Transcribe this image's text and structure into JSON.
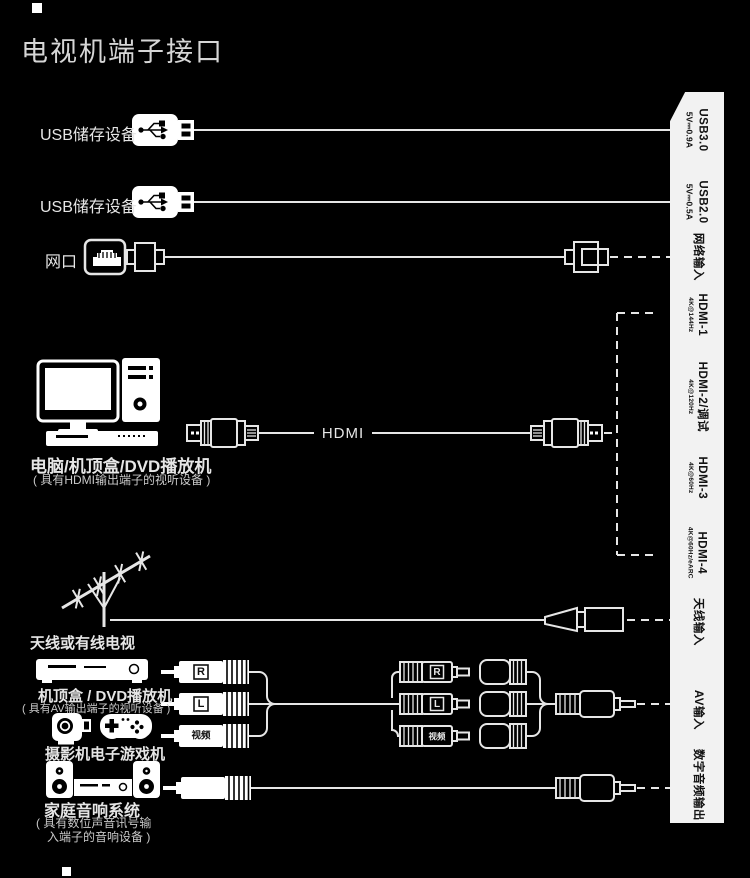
{
  "title": "电视机端子接口",
  "left": {
    "usb3_label": "USB储存设备",
    "usb2_label": "USB储存设备",
    "lan_label": "网口",
    "hdmi_device_label": "电脑/机顶盒/DVD播放机",
    "hdmi_device_sub": "( 具有HDMI输出端子的视听设备 )",
    "hdmi_cable_label": "HDMI",
    "antenna_label": "天线或有线电视",
    "av_device_label": "机顶盒 / DVD播放机",
    "av_device_sub": "( 具有AV输出端子的视听设备 )",
    "camera_label": "摄影机",
    "game_label": "电子游戏机",
    "audio_device_label": "家庭音响系统",
    "audio_device_sub1": "( 具有数位声音讯号输",
    "audio_device_sub2": "入端子的音响设备 )",
    "rca_r": "R",
    "rca_l": "L",
    "rca_v": "视频"
  },
  "panel": {
    "ports": [
      {
        "name": "USB3.0",
        "sub": "5V⎓0.9A"
      },
      {
        "name": "USB2.0",
        "sub": "5V⎓0.5A"
      },
      {
        "name": "网络输入",
        "sub": ""
      },
      {
        "name": "HDMI-1",
        "sub": "4K@144Hz"
      },
      {
        "name": "HDMI-2/调试",
        "sub": "4K@120Hz"
      },
      {
        "name": "HDMI-3",
        "sub": "4K@60Hz"
      },
      {
        "name": "HDMI-4",
        "sub": "4K@60Hz/eARC"
      },
      {
        "name": "天线输入",
        "sub": ""
      },
      {
        "name": "AV输入",
        "sub": ""
      },
      {
        "name": "数字音频输出",
        "sub": ""
      }
    ]
  },
  "colors": {
    "background": "#000000",
    "line": "#e6e6e6",
    "panel_bg": "#f2f2f2",
    "panel_text": "#111111",
    "title_text": "#d6d6d6"
  }
}
